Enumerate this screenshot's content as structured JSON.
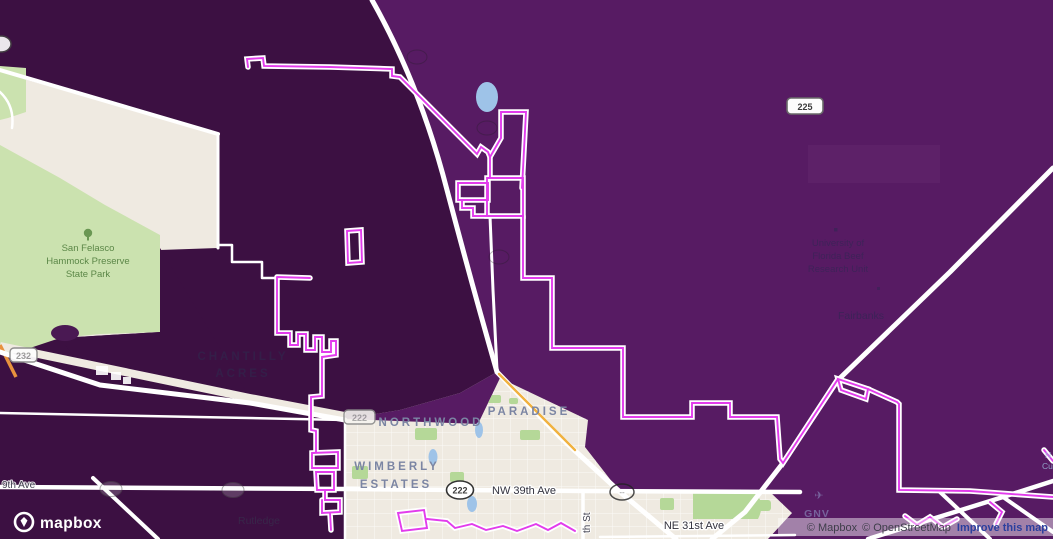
{
  "colors": {
    "overlay_dark_purple": "#3C1042",
    "overlay_medium_purple": "#571B63",
    "boundary_pink": "#E23CEC",
    "boundary_casing": "#FFFFFF",
    "land_beige": "#EFEAE1",
    "park_green": "#CBE2AF",
    "water_blue": "#9EC3E8",
    "highway_yellow": "#F0B13F"
  },
  "logo": {
    "wordmark": "mapbox"
  },
  "attribution": {
    "mapbox": "© Mapbox",
    "osm": "© OpenStreetMap",
    "improve": "Improve this map"
  },
  "shields": {
    "s225": "225",
    "s222_oval": "222",
    "s222_rect": "222",
    "s232": "232",
    "ghost_dashes": "--"
  },
  "labels": {
    "park": {
      "l1": "San Felasco",
      "l2": "Hammock Preserve",
      "l3": "State Park"
    },
    "chantilly": {
      "l1": "CHANTILLY",
      "l2": "ACRES"
    },
    "northwood": "NORTHWOOD",
    "paradise": "PARADISE",
    "wimberly": {
      "l1": "WIMBERLY",
      "l2": "ESTATES"
    },
    "rutledge": "Rutledge",
    "university": {
      "l1": "University of",
      "l2": "Florida Beef",
      "l3": "Research Unit"
    },
    "fairbanks": "Fairbanks",
    "airport": {
      "icon": "✈",
      "code": "GNV"
    },
    "streets": {
      "nw39": "NW 39th Ave",
      "ne31": "NE 31st Ave",
      "thst": "th St",
      "ave9": "9th Ave"
    },
    "edge_fragments": {
      "f1": "N",
      "f2": "Cu"
    }
  }
}
